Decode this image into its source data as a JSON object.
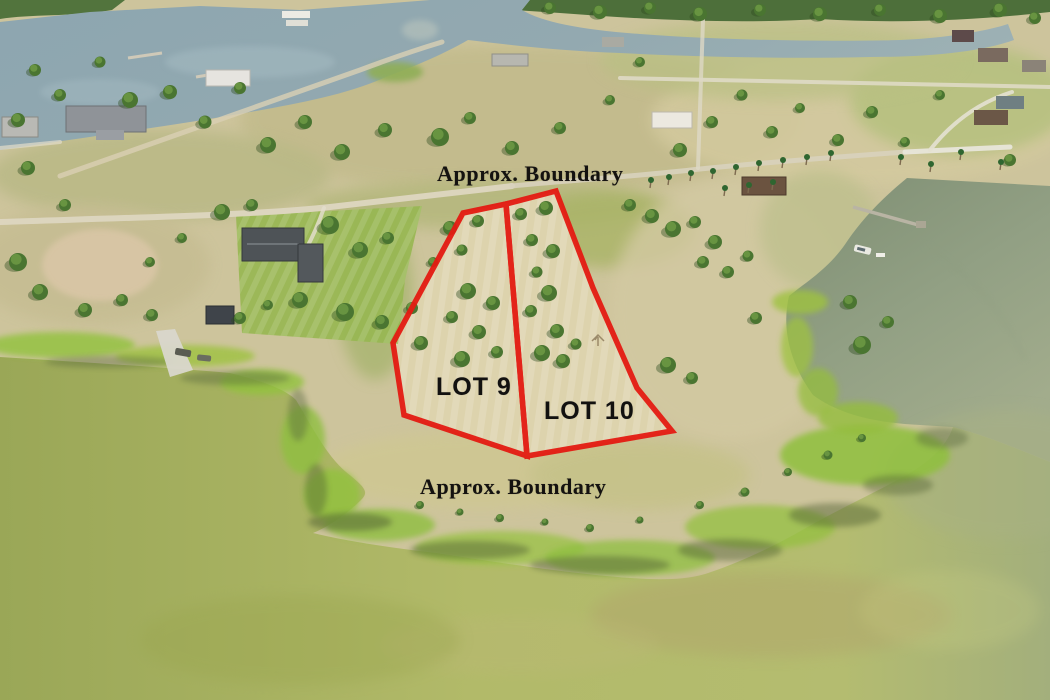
{
  "overlay": {
    "boundary_color": "#e41b12",
    "top_label": "Approx. Boundary",
    "bottom_label": "Approx. Boundary",
    "lots": [
      {
        "label": "LOT 9"
      },
      {
        "label": "LOT 10"
      }
    ]
  }
}
